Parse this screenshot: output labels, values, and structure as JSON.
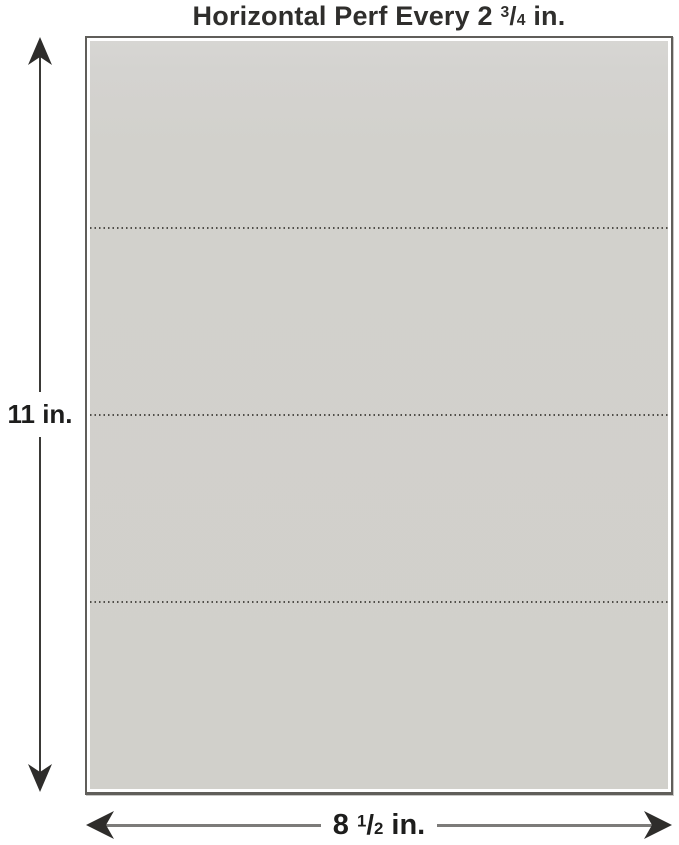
{
  "title": {
    "prefix": "Horizontal Perf Every 2",
    "fraction": {
      "numerator": "3",
      "slash": "/",
      "denominator": "4"
    },
    "suffix": "in."
  },
  "height_dimension": {
    "label": "11 in."
  },
  "width_dimension": {
    "prefix": "8",
    "fraction": {
      "numerator": "1",
      "slash": "/",
      "denominator": "2"
    },
    "suffix": "in."
  },
  "paper": {
    "perforation_line_count": 3,
    "section_count": 4
  },
  "colors": {
    "background": "#ffffff",
    "paper_fill": "#d2d1cc",
    "paper_fill_top": "#d7d6d3",
    "paper_border": "#605e5a",
    "perforation": "#504e49",
    "arrow_dark": "#2e2d2b",
    "h_line": "#7c7b79",
    "text": "#2f2e2c",
    "label_text": "#1d1d1c"
  }
}
